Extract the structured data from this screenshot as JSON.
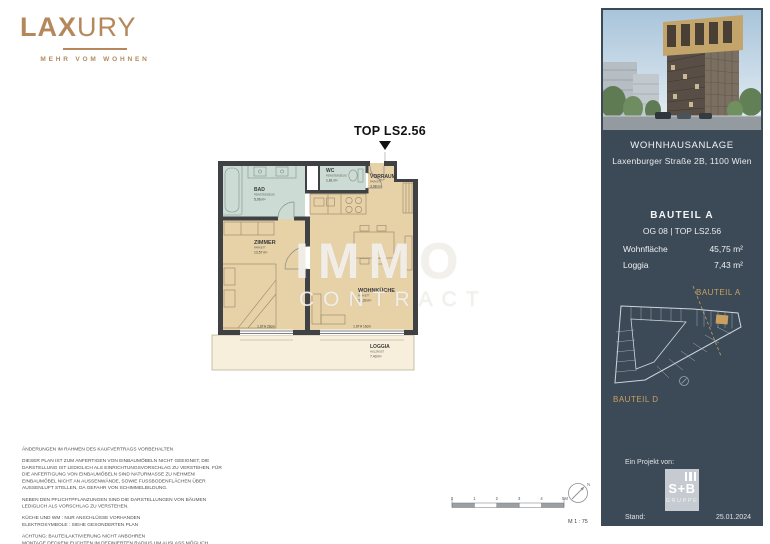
{
  "brand": {
    "name_bold": "LAX",
    "name_light": "URY",
    "tagline": "MEHR VOM WOHNEN"
  },
  "plan": {
    "title": "TOP LS2.56",
    "rooms": [
      {
        "id": "bad",
        "name": "BAD",
        "floor": "FEINSTEINZEUG",
        "area": "5,06 m²"
      },
      {
        "id": "wc",
        "name": "WC",
        "floor": "FEINSTEINZEUG",
        "area": "1,81 m²"
      },
      {
        "id": "vorraum",
        "name": "VORRAUM",
        "floor": "PARKETT",
        "area": "3,98 m²"
      },
      {
        "id": "zimmer",
        "name": "ZIMMER",
        "floor": "PARKETT",
        "area": "13,57 m²"
      },
      {
        "id": "wohnkueche",
        "name": "WOHNKÜCHE",
        "floor": "PARKETT",
        "area": "21,33 m²"
      },
      {
        "id": "loggia",
        "name": "LOGGIA",
        "floor": "HOLZROST",
        "area": "7,43 m²"
      }
    ],
    "dims": {
      "left_window": "1.STH 26cm",
      "right_window": "1.STH 16cm"
    },
    "scale": {
      "label": "M 1 : 75",
      "ticks": [
        "0",
        "1",
        "2",
        "3",
        "4",
        "5M"
      ],
      "north": "N"
    }
  },
  "watermark": {
    "line1": "IMMO",
    "line2": "CONTRACT"
  },
  "disclaimer": {
    "paragraphs": [
      "ÄNDERUNGEN IM RAHMEN DES KAUFVERTRAGS VORBEHALTEN",
      "DIESER PLAN IST ZUM ANFERTIGEN VON EINBAUMÖBELN NICHT GEEIGNET, DIE\nDARSTELLUNG IST LEDIGLICH ALS EINRICHTUNGSVORSCHLAG ZU VERSTEHEN. FÜR\nDIE ANFERTIGUNG VON EINBAUMÖBELN SIND NATURMASSE ZU NEHMEN!\nEINBAUMÖBEL NICHT AN AUSSENWÄNDE, SOWIE FUSSBODENFLÄCHEN ÜBER\nAUSSENLUFT STELLEN, DA GEFAHR VON SCHIMMELBILDUNG.",
      "NEBEN DEN PFLICHTPFLANZUNGEN SIND DIE DARSTELLUNGEN VON BÄUMEN\nLEDIGLICH ALS VORSCHLAG ZU VERSTEHEN.",
      "KÜCHE UND WM : NUR ANSCHLÜSSE VORHANDEN\nELEKTROSYMBOLE : SIEHE GESONDERTEN PLAN",
      "ACHTUNG: BAUTEILAKTIVIERUNG NICHT ANBOHREN\nMONTAGE DECKENLEUCHTEN IM DEFINIERTEN RADIUS UM AUSLASS MÖGLICH"
    ]
  },
  "sidebar": {
    "project": {
      "title": "WOHNHAUSANLAGE",
      "address": "Laxenburger Straße 2B, 1100 Wien"
    },
    "unit": {
      "bauteil": "BAUTEIL A",
      "line": "OG 08 | TOP LS2.56",
      "rows": [
        {
          "label": "Wohnfläche",
          "value": "45,75 m²"
        },
        {
          "label": "Loggia",
          "value": "7,43 m²"
        }
      ]
    },
    "siteplan": {
      "label_a": "BAUTEIL A",
      "label_d": "BAUTEIL D"
    },
    "footer": {
      "project_by": "Ein Projekt von:",
      "logo_top": "S+B",
      "logo_bottom": "GRUPPE",
      "stand_label": "Stand:",
      "stand_date": "25.01.2024"
    }
  },
  "colors": {
    "brand_copper": "#b5885c",
    "sidebar_bg": "#3c4a57",
    "accent_gold": "#c9a061",
    "room_tan": "#e7d2a8",
    "room_wet": "#ccdcd4",
    "loggia": "#f7efdb",
    "wall": "#3f4144"
  }
}
